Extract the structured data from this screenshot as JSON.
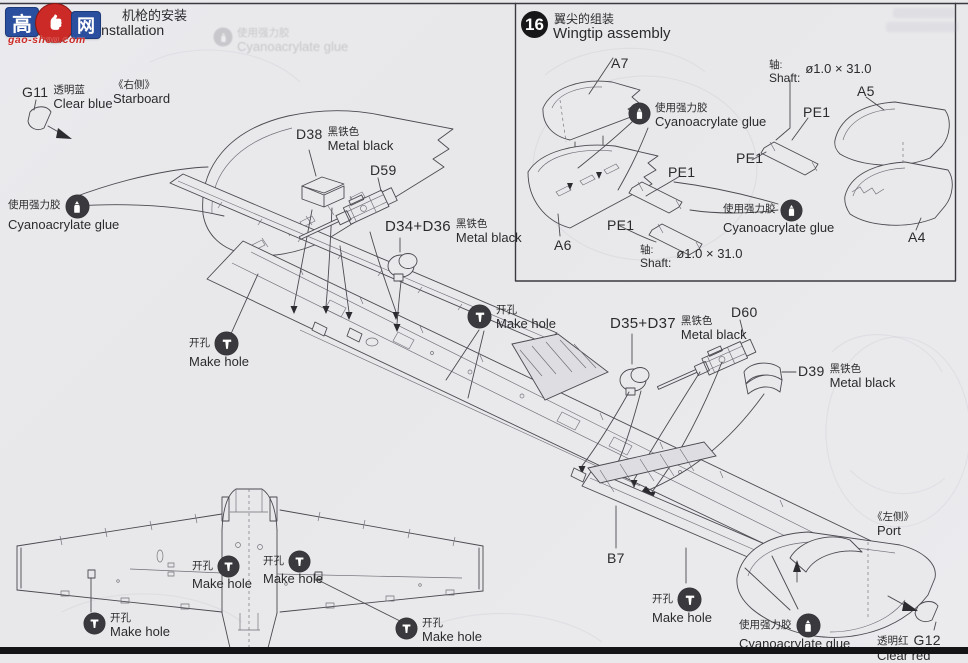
{
  "colors": {
    "bg": "#e9e9ec",
    "line": "#4a4a50",
    "text": "#2b2b2e",
    "bar": "#141416",
    "accent_red": "#cc2a26",
    "accent_blue": "#2a4f9e"
  },
  "header": {
    "title_zh": "机枪的安装",
    "title_en": "Machine gun installation"
  },
  "watermark": {
    "char_left": "高",
    "char_right": "网",
    "domain": "gao-shou.com"
  },
  "step16": {
    "number": "16",
    "title_zh": "翼尖的组装",
    "title_en": "Wingtip assembly",
    "parts": {
      "a7": "A7",
      "a6": "A6",
      "a5": "A5",
      "a4": "A4",
      "pe1": "PE1"
    },
    "shaft_zh": "轴:",
    "shaft_en": "Shaft:",
    "shaft_value": "ø1.0 × 31.0"
  },
  "notes": {
    "glue_zh": "使用强力胶",
    "glue_en": "Cyanoacrylate glue",
    "hole_zh": "开孔",
    "hole_en": "Make hole"
  },
  "sides": {
    "starboard_zh": "《右侧》",
    "starboard_en": "Starboard",
    "port_zh": "《左侧》",
    "port_en": "Port"
  },
  "parts": {
    "g11": {
      "id": "G11",
      "finish_zh": "透明蓝",
      "finish_en": "Clear blue"
    },
    "g12": {
      "id": "G12",
      "finish_zh": "透明红",
      "finish_en": "Clear red"
    },
    "d38": {
      "id": "D38",
      "finish_zh": "黑铁色",
      "finish_en": "Metal black"
    },
    "d39": {
      "id": "D39",
      "finish_zh": "黑铁色",
      "finish_en": "Metal black"
    },
    "d34_36": {
      "id": "D34+D36",
      "finish_zh": "黑铁色",
      "finish_en": "Metal black"
    },
    "d35_37": {
      "id": "D35+D37",
      "finish_zh": "黑铁色",
      "finish_en": "Metal black"
    },
    "d59": {
      "id": "D59"
    },
    "d60": {
      "id": "D60"
    },
    "b7": {
      "id": "B7"
    }
  }
}
